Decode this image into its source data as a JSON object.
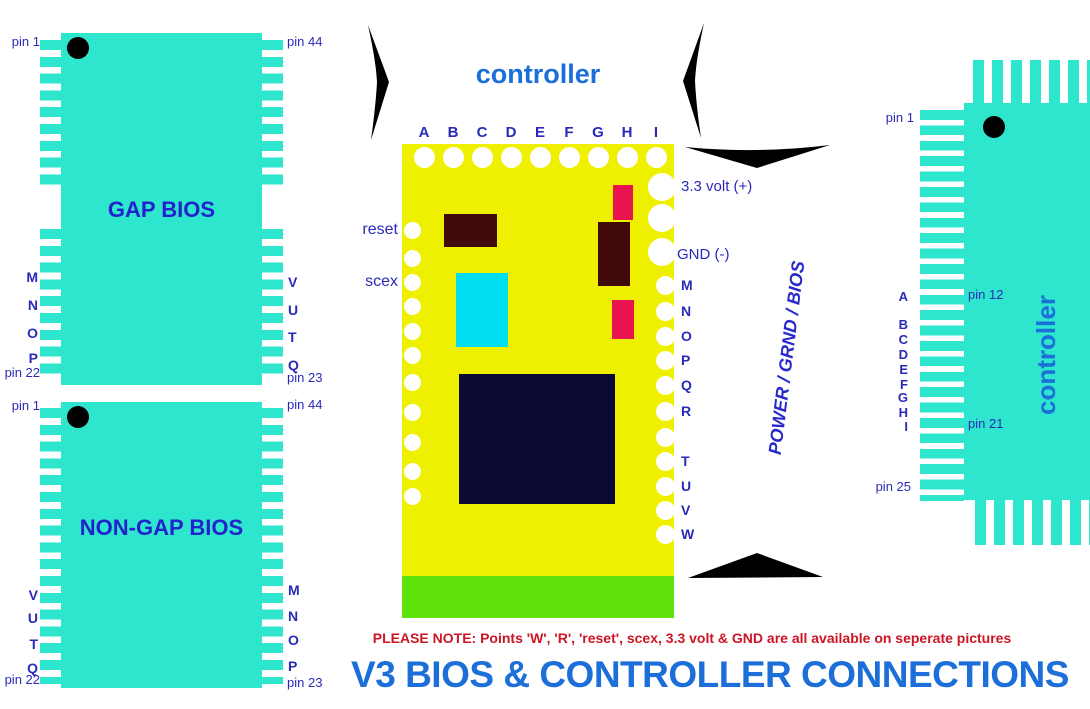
{
  "title": "V3 BIOS & CONTROLLER CONNECTIONS",
  "note": "PLEASE NOTE: Points 'W', 'R', 'reset', scex, 3.3 volt & GND are all available on seperate pictures",
  "colors": {
    "chip_cyan": "#2EE5CE",
    "board_yellow": "#EFEF00",
    "edge_green": "#5FE30A",
    "chip_navy": "#0A0A32",
    "dark_maroon": "#400808",
    "crimson_pink": "#E8134F",
    "aqua_rect": "#00DEF2",
    "label_blue": "#2A2AB8",
    "chip_text_blue": "#2323CC",
    "heading_blue": "#1C6FD9",
    "power_blue": "#2828CC",
    "note_red": "#CC1525"
  },
  "gap_bios": {
    "label": "GAP BIOS",
    "pin_top_left": "pin 1",
    "pin_top_right": "pin 44",
    "pin_bottom_left": "pin 22",
    "pin_bottom_right": "pin 23",
    "left_points": [
      "M",
      "N",
      "O",
      "P"
    ],
    "right_points": [
      "V",
      "U",
      "T",
      "Q"
    ]
  },
  "non_gap_bios": {
    "label": "NON-GAP BIOS",
    "pin_top_left": "pin 1",
    "pin_top_right": "pin 44",
    "pin_bottom_left": "pin 22",
    "pin_bottom_right": "pin 23",
    "left_points": [
      "V",
      "U",
      "T",
      "Q"
    ],
    "right_points": [
      "M",
      "N",
      "O",
      "P"
    ]
  },
  "board": {
    "heading": "controller",
    "top_points": [
      "A",
      "B",
      "C",
      "D",
      "E",
      "F",
      "G",
      "H",
      "I"
    ],
    "left_labels": [
      "reset",
      "scex"
    ],
    "power_label": "3.3 volt (+)",
    "gnd_label": "GND (-)",
    "right_points_upper": [
      "M",
      "N",
      "O",
      "P",
      "Q",
      "R"
    ],
    "right_points_lower": [
      "T",
      "U",
      "V",
      "W"
    ],
    "rotated_label": "POWER / GRND / BIOS"
  },
  "connector": {
    "label": "controller",
    "pin_first": "pin 1",
    "pin_mid_top": "pin 12",
    "pin_mid_bottom": "pin 21",
    "pin_last": "pin 25",
    "points": [
      "A",
      "B",
      "C",
      "D",
      "E",
      "F",
      "G",
      "H",
      "I"
    ]
  }
}
